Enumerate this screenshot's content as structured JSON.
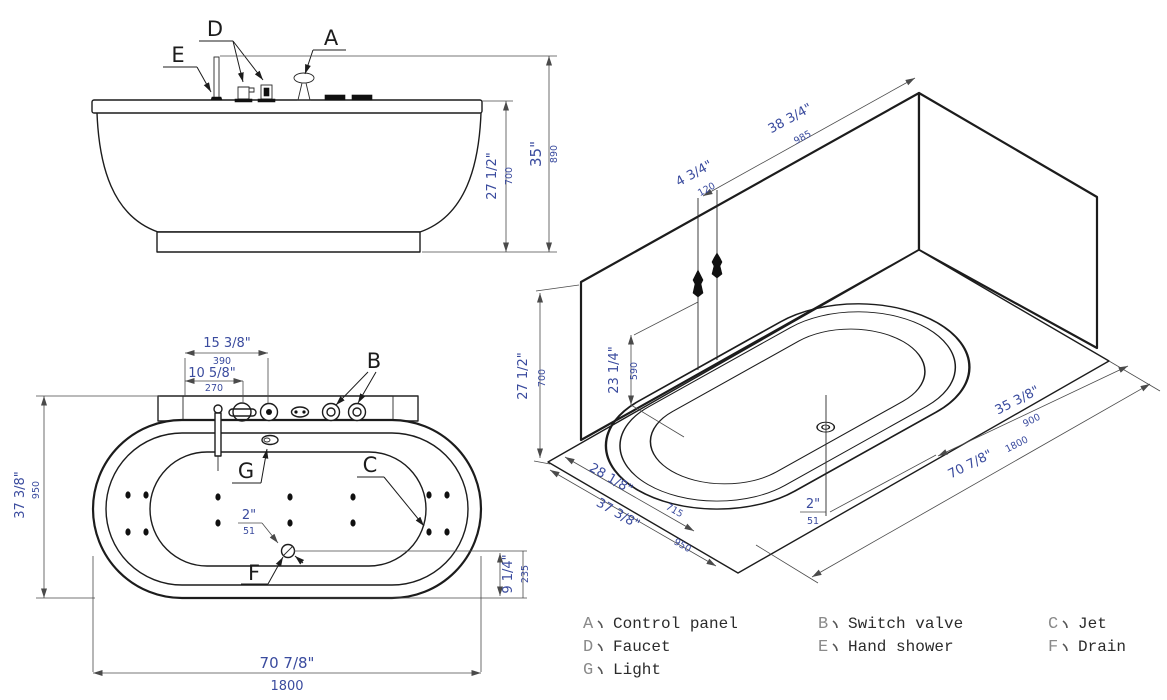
{
  "drawing": {
    "subject": "whirlpool bathtub installation drawing",
    "colors": {
      "line": "#1c1c1c",
      "dimension_text": "#3a4b9e",
      "legend_letter": "#8a8a8a",
      "legend_text": "#2b2b2b",
      "background": "#ffffff"
    },
    "front_view": {
      "callouts": {
        "D": "D",
        "A": "A",
        "E": "E"
      },
      "dims": {
        "rim_height": {
          "in": "27 1/2\"",
          "mm": "700"
        },
        "total_height": {
          "in": "35\"",
          "mm": "890"
        }
      }
    },
    "plan_view": {
      "callouts": {
        "B": "B",
        "G": "G",
        "C": "C",
        "F": "F"
      },
      "dims": {
        "control_offset": {
          "in": "15 3/8\"",
          "mm": "390"
        },
        "faucet_offset": {
          "in": "10 5/8\"",
          "mm": "270"
        },
        "width": {
          "in": "37 3/8\"",
          "mm": "950"
        },
        "drain_size": {
          "in": "2\"",
          "mm": "51"
        },
        "drain_offset": {
          "in": "9 1/4\"",
          "mm": "235"
        },
        "length": {
          "in": "70 7/8\"",
          "mm": "1800"
        }
      }
    },
    "iso_view": {
      "dims": {
        "faucet_to_corner": {
          "in": "38 3/4\"",
          "mm": "985"
        },
        "fixture_spacing": {
          "in": "4 3/4\"",
          "mm": "120"
        },
        "fixture_height": {
          "in": "23 1/4\"",
          "mm": "590"
        },
        "wall_height": {
          "in": "27 1/2\"",
          "mm": "700"
        },
        "drain_from_side": {
          "in": "28 1/8\"",
          "mm": "715"
        },
        "width": {
          "in": "37 3/8\"",
          "mm": "950"
        },
        "drain_from_end": {
          "in": "35 3/8\"",
          "mm": "900"
        },
        "length": {
          "in": "70 7/8\"",
          "mm": "1800"
        },
        "drain_size": {
          "in": "2\"",
          "mm": "51"
        }
      }
    },
    "legend": {
      "separator": "、",
      "items": [
        {
          "key": "A",
          "label": "Control panel"
        },
        {
          "key": "B",
          "label": "Switch valve"
        },
        {
          "key": "C",
          "label": "Jet"
        },
        {
          "key": "D",
          "label": "Faucet"
        },
        {
          "key": "E",
          "label": "Hand shower"
        },
        {
          "key": "F",
          "label": "Drain"
        },
        {
          "key": "G",
          "label": "Light"
        }
      ]
    }
  }
}
